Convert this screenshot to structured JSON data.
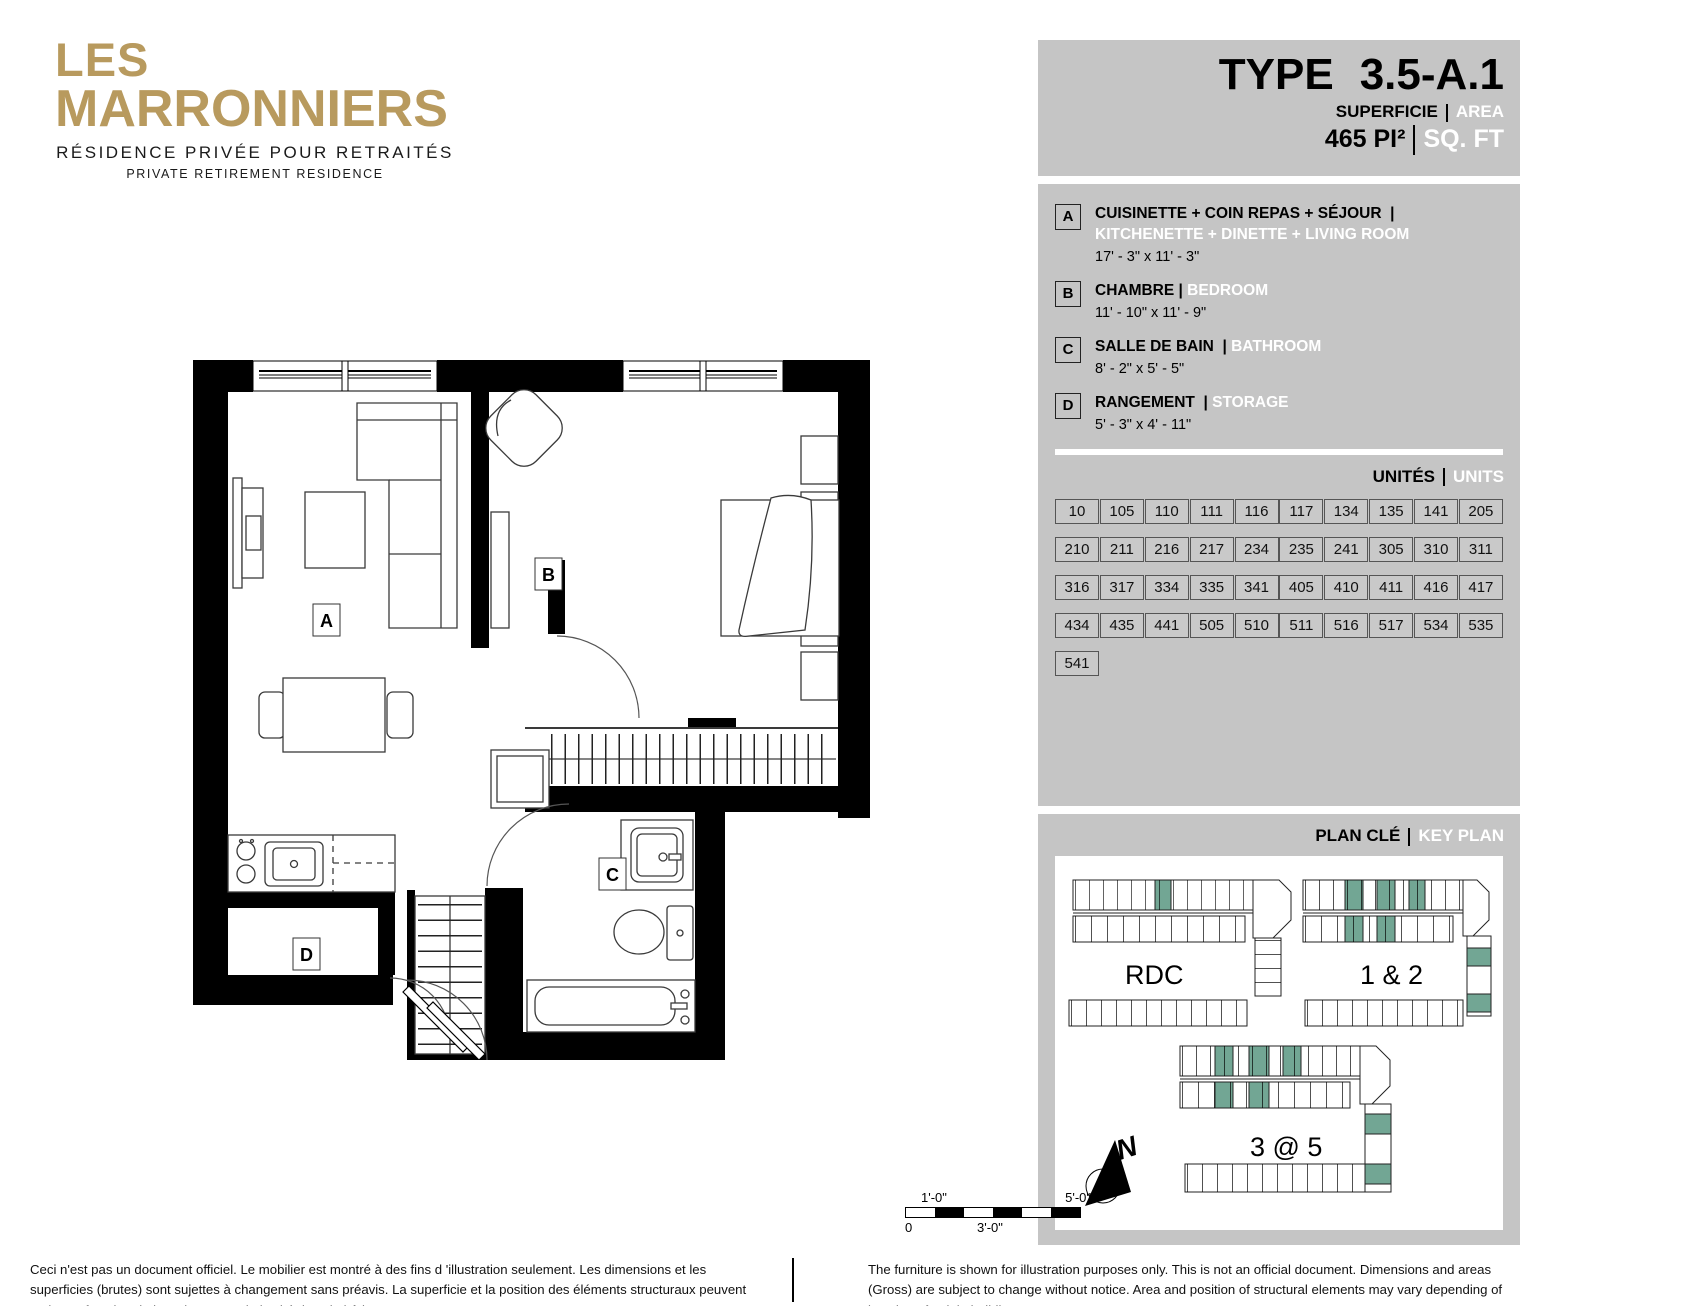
{
  "brand": {
    "line1": "LES",
    "line2": "MARRONNIERS",
    "subtitle_fr": "RÉSIDENCE PRIVÉE POUR RETRAITÉS",
    "subtitle_en": "PRIVATE RETIREMENT RESIDENCE"
  },
  "header": {
    "type_label": "TYPE",
    "type_value": "3.5-A.1",
    "superficie_label": "SUPERFICIE",
    "area_label": "AREA",
    "area_value": "465 PI²",
    "sqft_label": "SQ. FT"
  },
  "legend": {
    "items": [
      {
        "key": "A",
        "fr": "CUISINETTE + COIN REPAS + SÉJOUR",
        "en": "KITCHENETTE + DINETTE + LIVING ROOM",
        "dims": "17' - 3\" x 11' - 3\""
      },
      {
        "key": "B",
        "fr": "CHAMBRE",
        "en": "BEDROOM",
        "dims": "11' - 10\" x 11' - 9\""
      },
      {
        "key": "C",
        "fr": "SALLE DE BAIN",
        "en": "BATHROOM",
        "dims": "8' - 2\" x 5' - 5\""
      },
      {
        "key": "D",
        "fr": "RANGEMENT",
        "en": "STORAGE",
        "dims": "5' - 3\" x 4' - 11\""
      }
    ]
  },
  "units": {
    "label_fr": "UNITÉS",
    "label_en": "UNITS",
    "numbers": [
      "10",
      "105",
      "110",
      "111",
      "116",
      "117",
      "134",
      "135",
      "141",
      "205",
      "210",
      "211",
      "216",
      "217",
      "234",
      "235",
      "241",
      "305",
      "310",
      "311",
      "316",
      "317",
      "334",
      "335",
      "341",
      "405",
      "410",
      "411",
      "416",
      "417",
      "434",
      "435",
      "441",
      "505",
      "510",
      "511",
      "516",
      "517",
      "534",
      "535",
      "541"
    ]
  },
  "key_plan": {
    "label_fr": "PLAN CLÉ",
    "label_en": "KEY PLAN",
    "floors": {
      "ground": "RDC",
      "low": "1 & 2",
      "high": "3 @ 5"
    },
    "north_label": "N"
  },
  "plan": {
    "room_labels": {
      "a": "A",
      "b": "B",
      "c": "C",
      "d": "D"
    }
  },
  "scale_bar": {
    "top_left": "1'-0\"",
    "top_right": "5'-0\"",
    "bottom_left": "0",
    "bottom_mid": "3'-0\""
  },
  "footer": {
    "fr": "Ceci n'est pas un document officiel.  Le mobilier est montré à des fins d 'illustration seulement.  Les dimensions et les superficies (brutes) sont sujettes à changement sans préavis. La superficie et la position des éléments structuraux peuvent varier en fonction de l'emplacement de l'unité dans le bâtiment.",
    "en": "The furniture is shown for illustration purposes only.  This is not an official document.  Dimensions and areas (Gross) are subject to change without notice.  Area and position of structural elements may vary depending of location of unit in building."
  },
  "colors": {
    "gold": "#b89a5e",
    "panel_gray": "#c5c5c5",
    "teal": "#72a694",
    "black": "#000000",
    "white": "#ffffff"
  }
}
